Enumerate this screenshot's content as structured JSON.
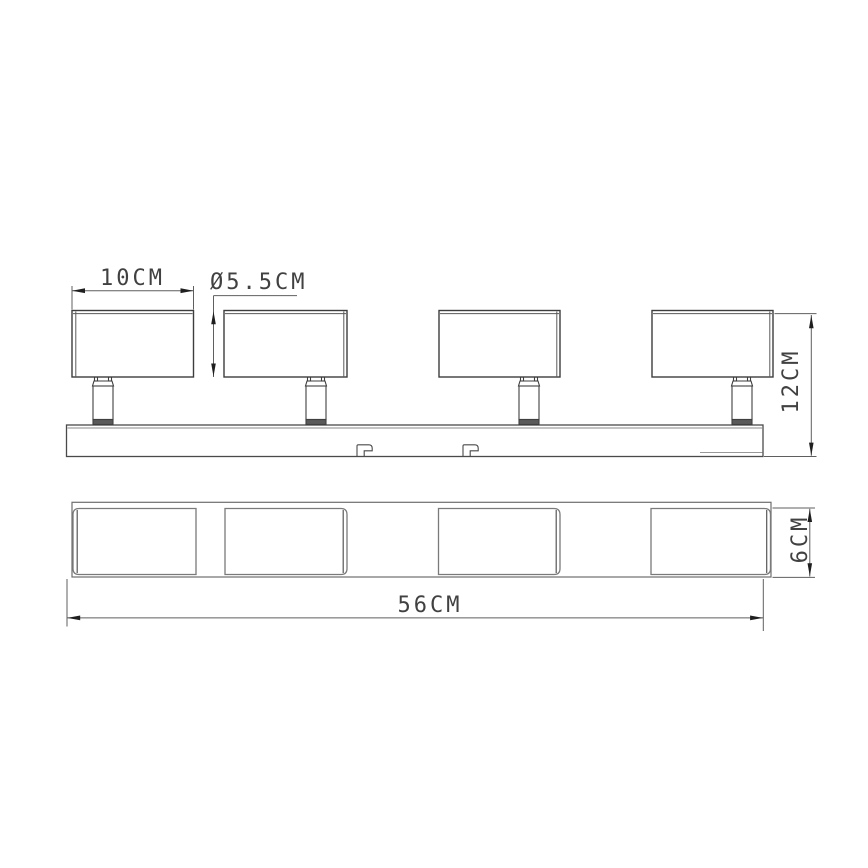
{
  "labels": {
    "head_width": "10CM",
    "head_diameter": "Ø5.5CM",
    "total_height": "12CM",
    "bar_length": "56CM",
    "bar_depth": "6CM"
  },
  "spot_count": 4,
  "colors": {
    "background": "#ffffff",
    "outline_dark": "#3f3f3f",
    "outline_light": "#757575",
    "dimension_line": "#5f5f5f",
    "arrow": "#1f1f1f",
    "text": "#414141",
    "stem_band": "#5a5a5a"
  }
}
